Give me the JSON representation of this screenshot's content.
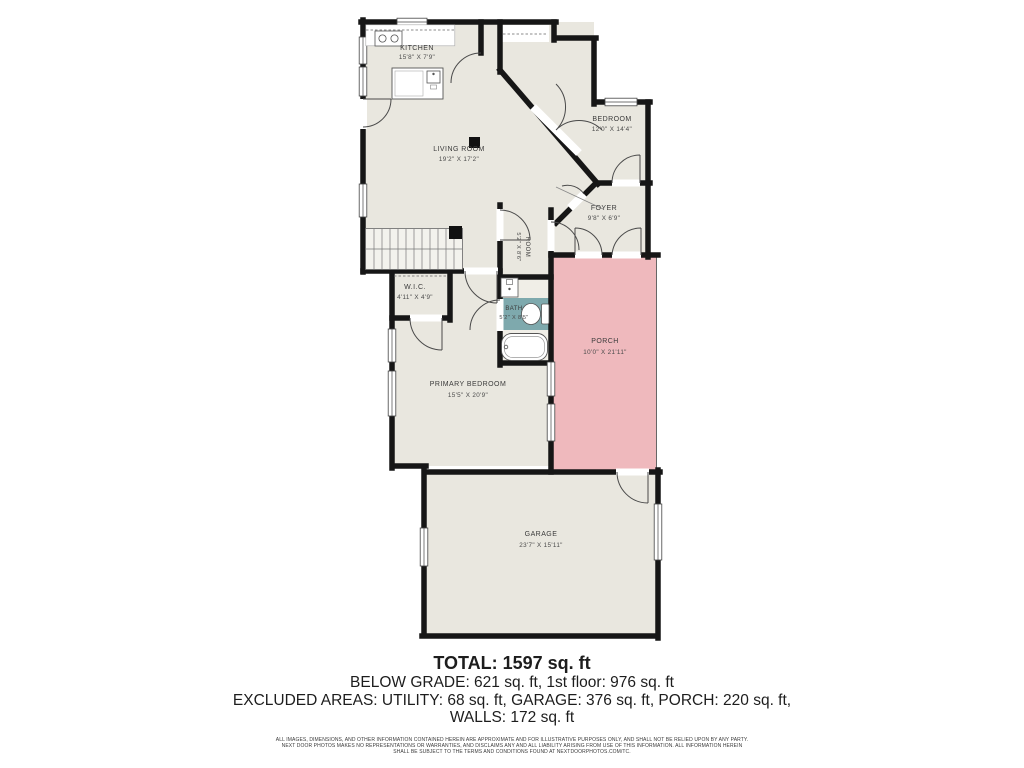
{
  "floor_plan": {
    "rooms": [
      {
        "name": "KITCHEN",
        "dims": "15'8\" X 7'9\""
      },
      {
        "name": "LIVING ROOM",
        "dims": "19'2\" X 17'2\""
      },
      {
        "name": "BEDROOM",
        "dims": "12'0\" X 14'4\""
      },
      {
        "name": "FOYER",
        "dims": "9'8\" X 6'9\""
      },
      {
        "name": "ROOM",
        "dims": "5'2\" X 8'6\""
      },
      {
        "name": "W.I.C.",
        "dims": "4'11\" X 4'9\""
      },
      {
        "name": "BATH",
        "dims": "5'2\" X 8'5\""
      },
      {
        "name": "PRIMARY BEDROOM",
        "dims": "15'5\" X 20'9\""
      },
      {
        "name": "PORCH",
        "dims": "10'0\" X 21'11\""
      },
      {
        "name": "GARAGE",
        "dims": "23'7\" X 15'11\""
      }
    ],
    "colors": {
      "floor": "#e9e7df",
      "bath_floor": "#f0eee7",
      "bath": "#7ea9ad",
      "porch": "#efb9bd",
      "wall": "#161616"
    }
  },
  "summary": {
    "total": "TOTAL: 1597 sq. ft",
    "below_grade": "BELOW GRADE: 621 sq. ft, 1st floor: 976 sq. ft",
    "excluded": "EXCLUDED AREAS: UTILITY: 68 sq. ft, GARAGE: 376 sq. ft, PORCH: 220 sq. ft,",
    "walls": "WALLS: 172 sq. ft"
  },
  "disclaimer": {
    "line1": "ALL IMAGES, DIMENSIONS, AND OTHER INFORMATION CONTAINED HEREIN ARE APPROXIMATE AND FOR ILLUSTRATIVE PURPOSES ONLY, AND SHALL NOT BE RELIED UPON BY ANY PARTY.",
    "line2": "NEXT DOOR PHOTOS MAKES NO REPRESENTATIONS OR WARRANTIES, AND DISCLAIMS ANY AND ALL LIABILITY ARISING FROM USE OF THIS INFORMATION. ALL INFORMATION HEREIN",
    "line3": "SHALL BE SUBJECT TO THE TERMS AND CONDITIONS FOUND AT NEXTDOORPHOTOS.COM/TC."
  }
}
